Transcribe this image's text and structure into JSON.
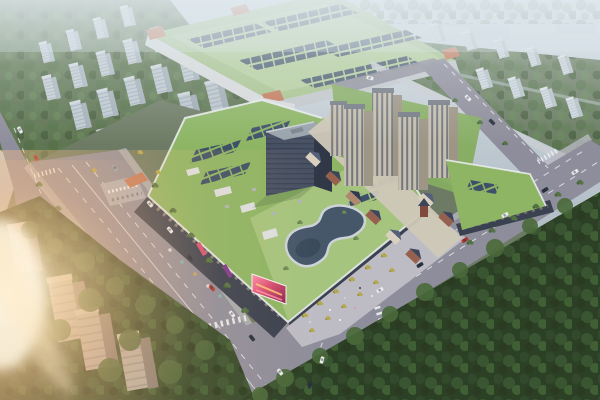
{
  "scene": {
    "type": "aerial-architectural-rendering",
    "caption": "Aerial dusk rendering of a mixed-use commercial complex: a green-roofed shopping mall with rooftop solar panels and a guitar-shaped skylight, beige residential towers, a European-style retail street, a large green-roofed factory hall behind, tree-lined multi-lane avenues with traffic, hazy gray apartment blocks in the distance, a dense dark forest at lower right and warm sun flare at the left edge.",
    "elements": [
      {
        "name": "distant-city",
        "label": "hazy distant city blocks"
      },
      {
        "name": "nw-residential-rows",
        "label": "rows of gray apartment slabs, upper left"
      },
      {
        "name": "factory-building",
        "label": "large green-roofed factory / exhibition hall with skylight panel rows and orange corner accents"
      },
      {
        "name": "ne-residential-area",
        "label": "white apartment slabs among trees, upper right"
      },
      {
        "name": "boundary-wall",
        "label": "light perimeter wall along north-east road"
      },
      {
        "name": "mall-complex",
        "label": "shopping mall podium with green roofs, solar arrays and skylights"
      },
      {
        "name": "guitar-skylight",
        "label": "guitar-shaped rooftop skylight"
      },
      {
        "name": "office-tower",
        "label": "dark office slab tower"
      },
      {
        "name": "residential-towers",
        "label": "five beige residential high-rises"
      },
      {
        "name": "euro-retail-street",
        "label": "pitched-roof European style retail street"
      },
      {
        "name": "east-podium",
        "label": "green-roofed retail podium, east side"
      },
      {
        "name": "led-screen",
        "label": "large pink LED advertising screen at mall corner"
      },
      {
        "name": "entrance-canopy",
        "label": "orange west entrance canopy with parking lot"
      },
      {
        "name": "main-avenue",
        "label": "wide tree-lined avenue running lower-left"
      },
      {
        "name": "cross-road",
        "label": "diagonal road along forest to right edge"
      },
      {
        "name": "ne-road",
        "label": "road along north-east boundary"
      },
      {
        "name": "plaza",
        "label": "entry plaza with yellow trees"
      },
      {
        "name": "se-forest",
        "label": "dense dark forest, lower right"
      },
      {
        "name": "sw-trees-towers",
        "label": "dark trees and gray towers, lower left"
      },
      {
        "name": "sun-flare",
        "label": "warm lens flare, left edge"
      },
      {
        "name": "traffic",
        "label": "cars on roads"
      }
    ]
  },
  "palette": {
    "haze_top": "#d3dde2",
    "haze_mid": "#b9c3cb",
    "haze_low": "#9fa9b1",
    "distant_building": "#c3ced6",
    "distant_tree": "#72836a",
    "wall_light": "#c8cdd2",
    "factory_roof": "#a9c48f",
    "factory_roof_light": "#bed6a6",
    "factory_panel": "#4c5d70",
    "factory_accent": "#c4795a",
    "factory_edge": "#d7dadb",
    "mall_roof": "#8db564",
    "mall_roof_light": "#a5c47e",
    "solar_panel": "#3e5068",
    "roof_white": "#dcdfe1",
    "facade_dark": "#3a4150",
    "office_front": "#475164",
    "office_side": "#303848",
    "office_roof": "#9aa2ac",
    "tower_front": "#c6beae",
    "tower_side": "#9d9585",
    "tower_strip": "#646b76",
    "tower_roof": "#757b84",
    "euro_wall_brick": "#95604d",
    "euro_wall_cream": "#d9d0bf",
    "euro_roof": "#3c455c",
    "street_paving": "#cfc8b8",
    "road": "#8e8d9b",
    "sidewalk": "#b6b8c0",
    "lane_white": "#eceef2",
    "lawn": "#85ad60",
    "plaza": "#bdbcc4",
    "tree_mid": "#537243",
    "tree_dark": "#3f5a32",
    "tree_yellow": "#b5a84e",
    "forest_dark": "#2c4026",
    "sw_ground": "#33482a",
    "led_pink": "#d94f72",
    "led_crimson": "#8a2550",
    "car_white": "#e9ebee",
    "car_dark": "#2c3440",
    "car_red": "#ad3a32",
    "flare_warm": "#ffd9a4"
  }
}
